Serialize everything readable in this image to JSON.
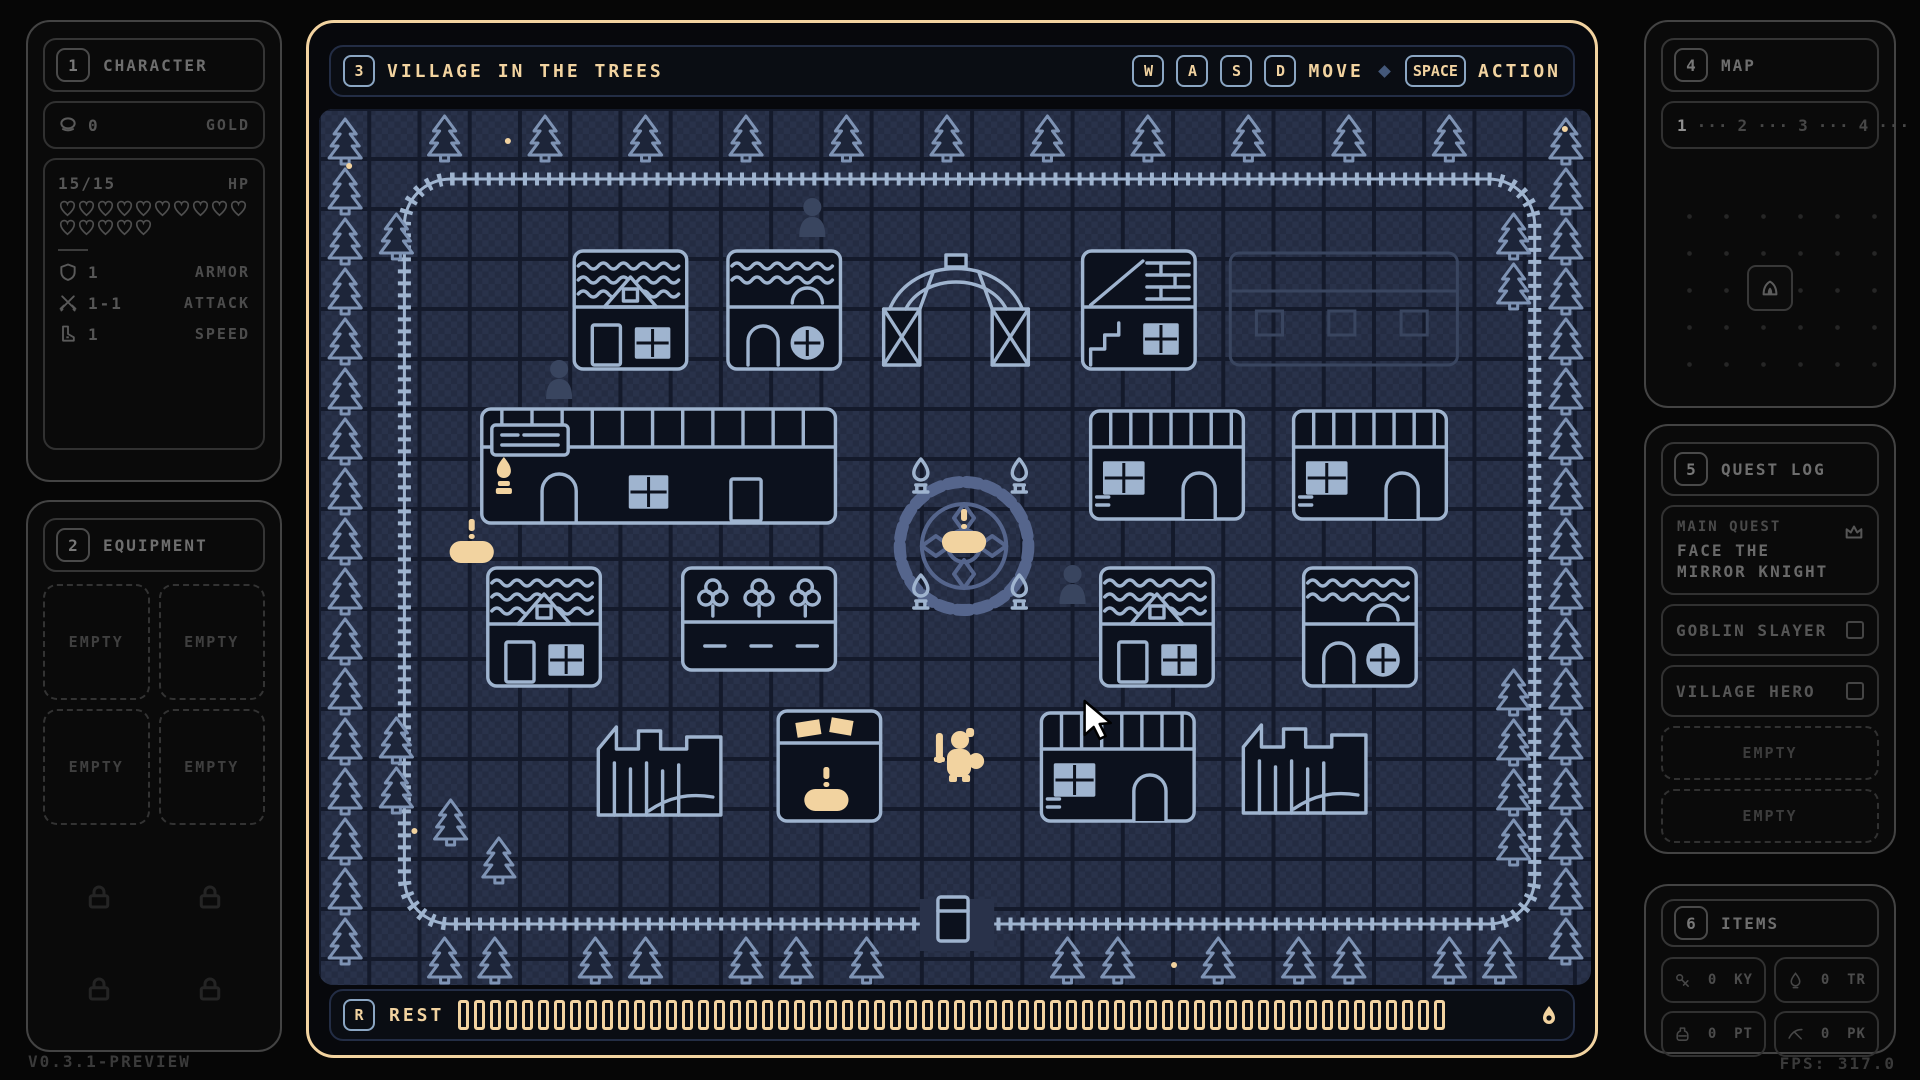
{
  "meta": {
    "version": "V0.3.1-PREVIEW",
    "fps": "FPS: 317.0"
  },
  "colors": {
    "accent_gold": "#f2d3a0",
    "keycap_steel": "#8ba6c3",
    "map_outline_bright": "#9fb4cf",
    "map_outline_dim": "#55658c",
    "map_tile": "#29324a",
    "frame_border": "#f2d3a0",
    "panel_border": "#434343",
    "panel_text": "#6e6e6e"
  },
  "character": {
    "hotkey": "1",
    "title": "CHARACTER",
    "gold": {
      "icon": "coin-icon",
      "value": "0",
      "label": "GOLD"
    },
    "hp": {
      "value": "15/15",
      "label": "HP",
      "hearts": 15
    },
    "stats": {
      "armor": {
        "icon": "shield-icon",
        "value": "1",
        "label": "ARMOR"
      },
      "attack": {
        "icon": "swords-icon",
        "value": "1-1",
        "label": "ATTACK"
      },
      "speed": {
        "icon": "boot-icon",
        "value": "1",
        "label": "SPEED"
      }
    }
  },
  "equipment": {
    "hotkey": "2",
    "title": "EQUIPMENT",
    "slots": [
      "EMPTY",
      "EMPTY",
      "EMPTY",
      "EMPTY"
    ],
    "locked_count": 4,
    "lock_icon": "lock-icon"
  },
  "stage": {
    "hotkey": "3",
    "title": "VILLAGE IN THE TREES"
  },
  "controls": {
    "move_keys": [
      "W",
      "A",
      "S",
      "D"
    ],
    "move_label": "MOVE",
    "separator": "diamond-icon",
    "action_key": "SPACE",
    "action_label": "ACTION"
  },
  "map_panel": {
    "hotkey": "4",
    "title": "MAP",
    "levels": [
      "1",
      "2",
      "3",
      "4"
    ],
    "current_level": "1",
    "separator": "···",
    "end_icon": "skull-icon",
    "location_icon": "tent-icon"
  },
  "quest_log": {
    "hotkey": "5",
    "title": "QUEST LOG",
    "main_quest": {
      "label": "MAIN QUEST",
      "line1": "FACE THE",
      "line2": "MIRROR KNIGHT",
      "icon": "crown-icon"
    },
    "side_quests": [
      {
        "name": "GOBLIN SLAYER",
        "done": false
      },
      {
        "name": "VILLAGE HERO",
        "done": false
      }
    ],
    "empty_slots": [
      "EMPTY",
      "EMPTY"
    ]
  },
  "items": {
    "hotkey": "6",
    "title": "ITEMS",
    "slots": [
      {
        "icon": "key-icon",
        "count": "0",
        "code": "KY"
      },
      {
        "icon": "torch-icon",
        "count": "0",
        "code": "TR"
      },
      {
        "icon": "potion-icon",
        "count": "0",
        "code": "PT"
      },
      {
        "icon": "pickaxe-icon",
        "count": "0",
        "code": "PK"
      }
    ]
  },
  "rest": {
    "key": "R",
    "label": "REST",
    "segments": 62,
    "end_icon": "droplet-icon"
  }
}
